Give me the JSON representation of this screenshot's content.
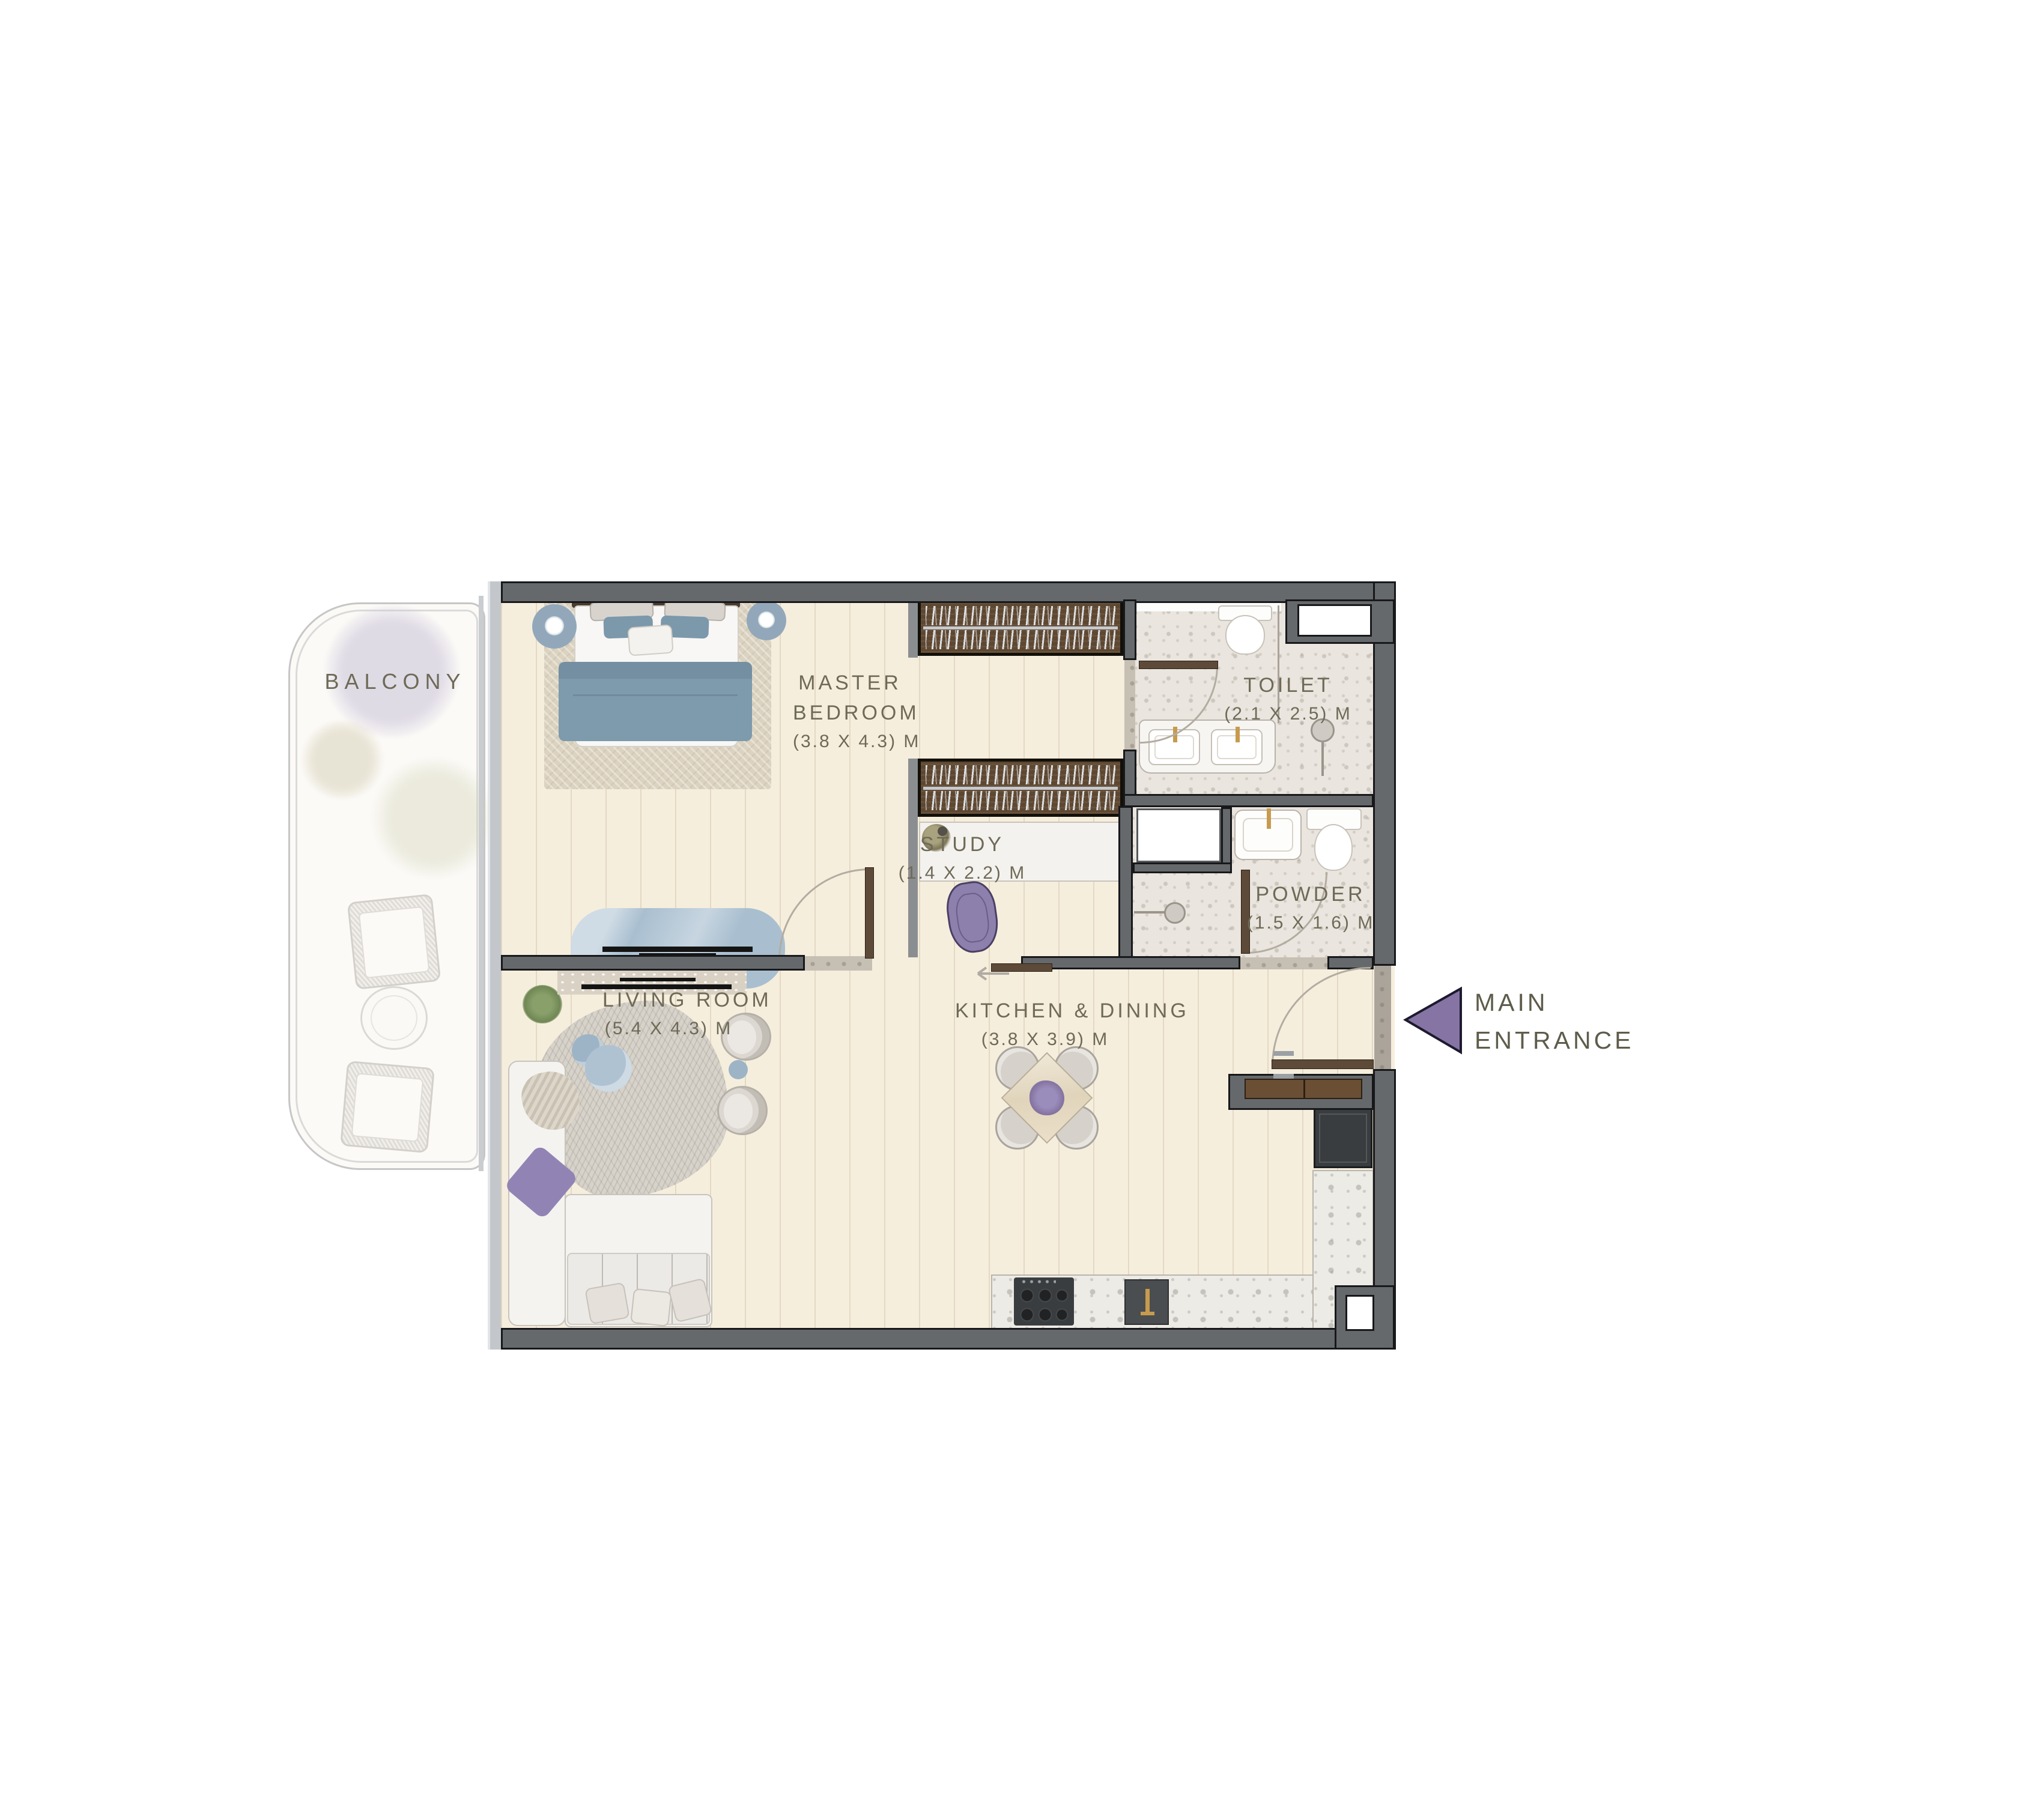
{
  "page": {
    "type": "apartment floor plan"
  },
  "colors": {
    "wall": "#66696c",
    "wall_outline": "#17181a",
    "label_text": "#6e6a57",
    "entrance_label_text": "#5e5c4a",
    "arrow_purple": "#8574a4",
    "wood_floor": "#f6eedd",
    "stone_floor": "#eae5de",
    "wardrobe_brown": "#5e4731",
    "door_brown": "#5d4a38",
    "furniture_blue": "#7e9aad",
    "accent_purple": "#9184b4",
    "counter_terrazzo": "#edebe6",
    "appliance_dark": "#3a3d3f"
  },
  "rooms": {
    "balcony": {
      "name": "BALCONY"
    },
    "master_bedroom": {
      "name_line1": "MASTER",
      "name_line2": "BEDROOM",
      "dims": "(3.8 X 4.3) M"
    },
    "living_room": {
      "name": "LIVING ROOM",
      "dims": "(5.4 X 4.3) M"
    },
    "kitchen_dining": {
      "name": "KITCHEN & DINING",
      "dims": "(3.8 X 3.9) M"
    },
    "study": {
      "name": "STUDY",
      "dims": "(1.4 X 2.2) M"
    },
    "toilet": {
      "name": "TOILET",
      "dims": "(2.1 X 2.5) M"
    },
    "powder": {
      "name": "POWDER",
      "dims": "(1.5 X 1.6) M"
    }
  },
  "entrance": {
    "name_line1": "MAIN",
    "name_line2": "ENTRANCE"
  }
}
